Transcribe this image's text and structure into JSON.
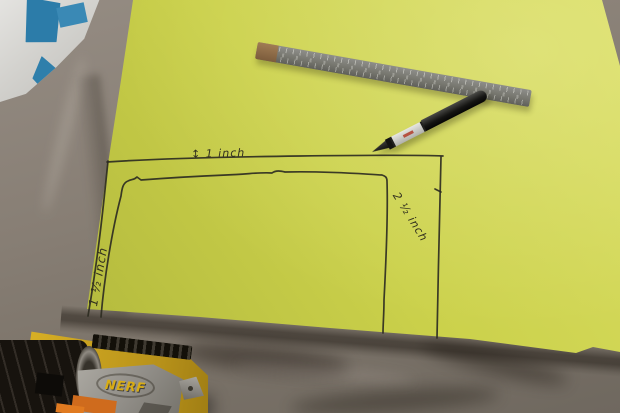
{
  "photo": {
    "annotations": {
      "top": "↕ 1 inch",
      "left": "1 ½ inch",
      "right": "2 ½ inch"
    },
    "nerf": {
      "logo": "NERF"
    },
    "colors": {
      "paper_yellow": "#cbd14b",
      "ink": "#2e2d22",
      "fabric_taupe": "#877e74",
      "fabric_dark": "#6f685f",
      "ruler_steel": "#77776f",
      "ruler_end_cap": "#8a6a48",
      "marker_black": "#141412",
      "marker_band_silver": "#c6c6c2",
      "marker_band_mark_red": "#b23c2a",
      "gun_yellow": "#c9a21f",
      "gun_gray": "#8f8c86",
      "gun_orange": "#cf6b1d",
      "bag_white": "#d2d1cd",
      "bag_blue": "#2c7ca9"
    }
  }
}
